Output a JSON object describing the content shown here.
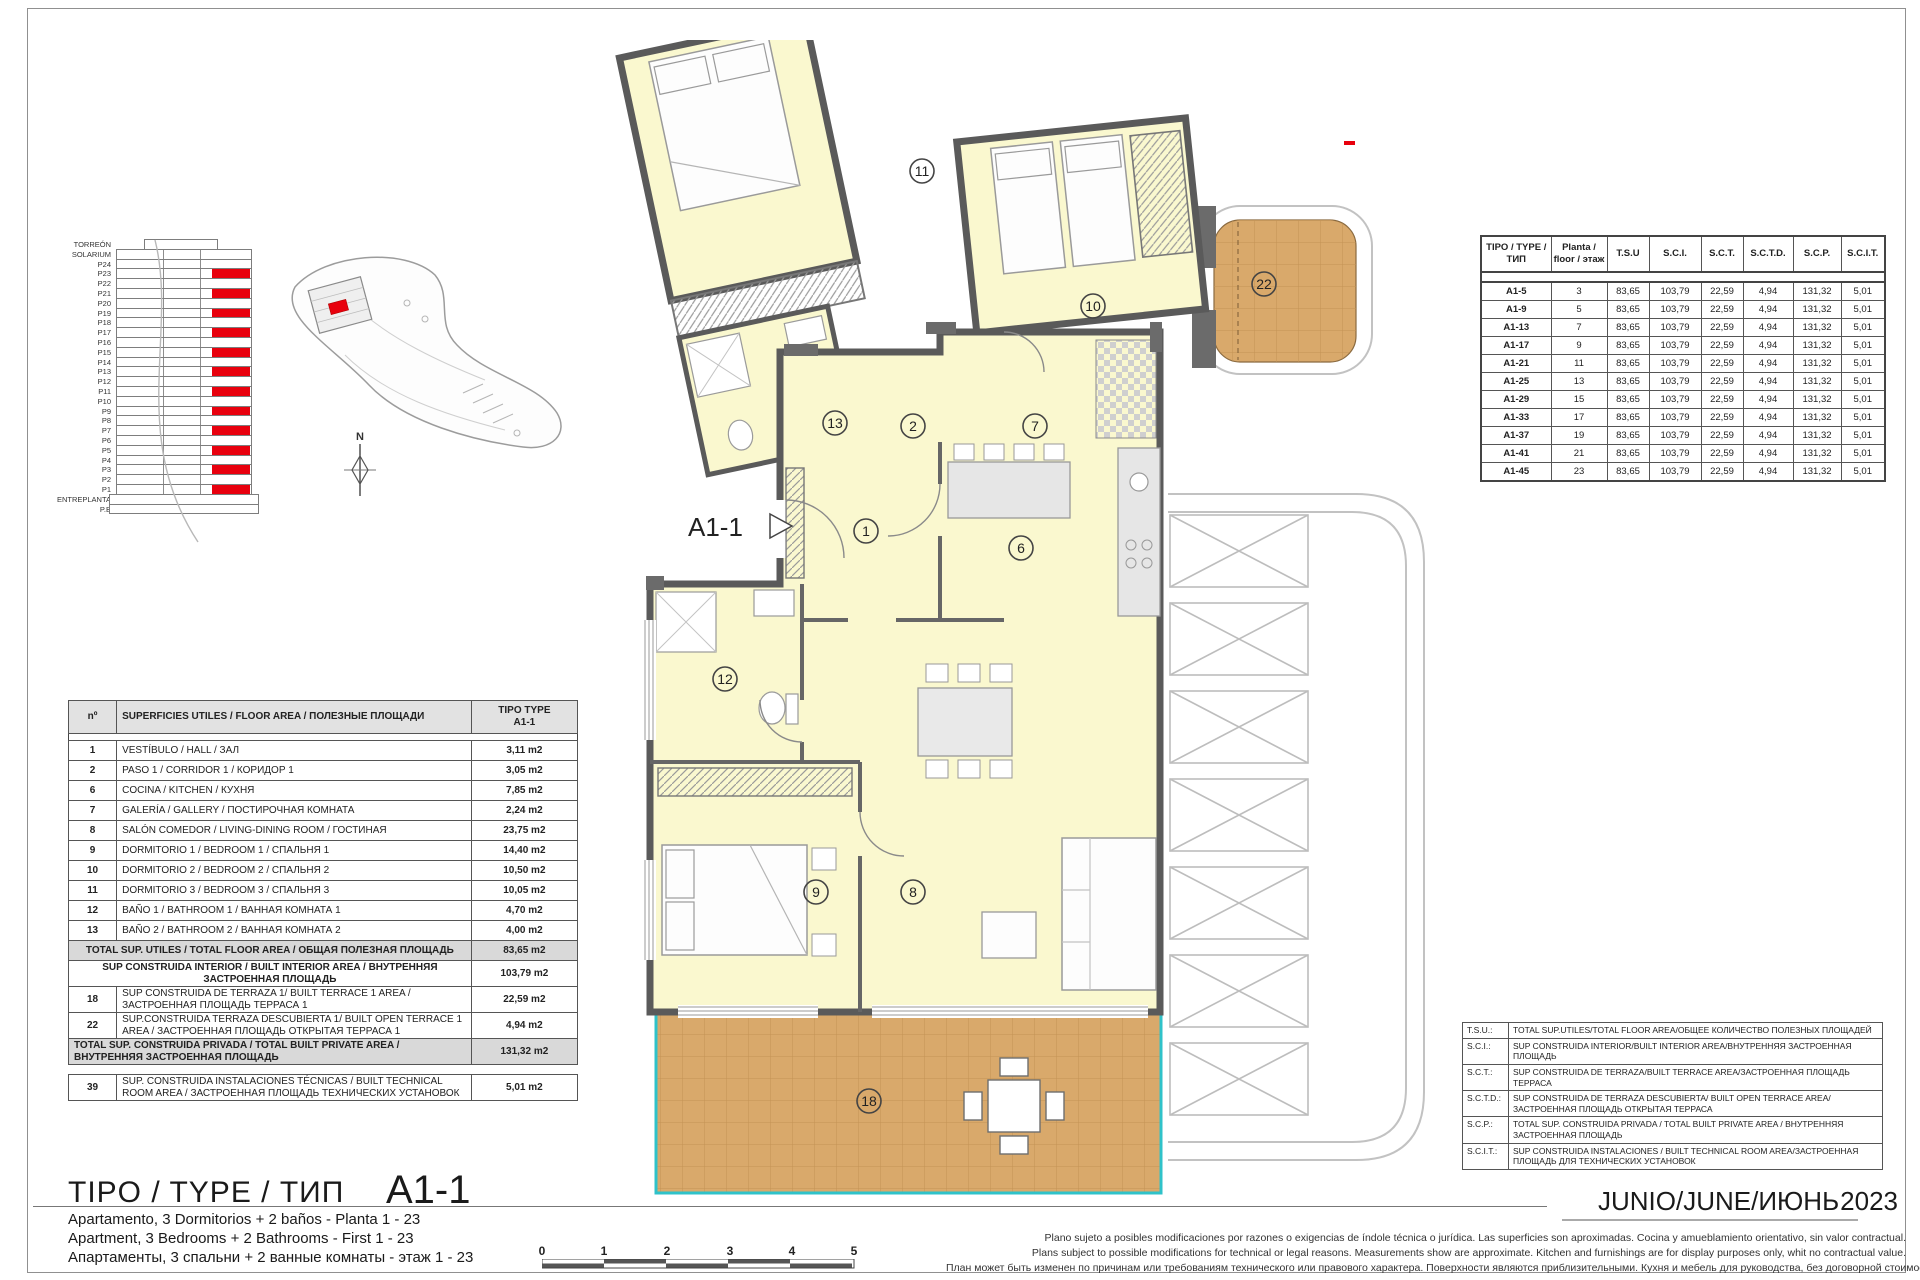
{
  "elevation": {
    "floors": [
      {
        "label": "TORREÓN",
        "red": false
      },
      {
        "label": "SOLARIUM",
        "red": false
      },
      {
        "label": "P24",
        "red": false
      },
      {
        "label": "P23",
        "red": true
      },
      {
        "label": "P22",
        "red": false
      },
      {
        "label": "P21",
        "red": true
      },
      {
        "label": "P20",
        "red": false
      },
      {
        "label": "P19",
        "red": true
      },
      {
        "label": "P18",
        "red": false
      },
      {
        "label": "P17",
        "red": true
      },
      {
        "label": "P16",
        "red": false
      },
      {
        "label": "P15",
        "red": true
      },
      {
        "label": "P14",
        "red": false
      },
      {
        "label": "P13",
        "red": true
      },
      {
        "label": "P12",
        "red": false
      },
      {
        "label": "P11",
        "red": true
      },
      {
        "label": "P10",
        "red": false
      },
      {
        "label": "P9",
        "red": true
      },
      {
        "label": "P8",
        "red": false
      },
      {
        "label": "P7",
        "red": true
      },
      {
        "label": "P6",
        "red": false
      },
      {
        "label": "P5",
        "red": true
      },
      {
        "label": "P4",
        "red": false
      },
      {
        "label": "P3",
        "red": true
      },
      {
        "label": "P2",
        "red": false
      },
      {
        "label": "P1",
        "red": true
      },
      {
        "label": "ENTREPLANTA",
        "red": false
      },
      {
        "label": "P.B",
        "red": false
      }
    ]
  },
  "compass": {
    "north": "N"
  },
  "plan": {
    "label": "A1-1",
    "rooms": {
      "r1": "1",
      "r2": "2",
      "r6": "6",
      "r7": "7",
      "r8": "8",
      "r9": "9",
      "r10": "10",
      "r11": "11",
      "r12": "12",
      "r13": "13",
      "r18": "18",
      "r22": "22"
    }
  },
  "type_table": {
    "headers": [
      "TIPO / TYPE / ТИП",
      "Planta / floor / этаж",
      "T.S.U",
      "S.C.I.",
      "S.C.T.",
      "S.C.T.D.",
      "S.C.P.",
      "S.C.I.T."
    ],
    "rows": [
      [
        "A1-5",
        "3",
        "83,65",
        "103,79",
        "22,59",
        "4,94",
        "131,32",
        "5,01"
      ],
      [
        "A1-9",
        "5",
        "83,65",
        "103,79",
        "22,59",
        "4,94",
        "131,32",
        "5,01"
      ],
      [
        "A1-13",
        "7",
        "83,65",
        "103,79",
        "22,59",
        "4,94",
        "131,32",
        "5,01"
      ],
      [
        "A1-17",
        "9",
        "83,65",
        "103,79",
        "22,59",
        "4,94",
        "131,32",
        "5,01"
      ],
      [
        "A1-21",
        "11",
        "83,65",
        "103,79",
        "22,59",
        "4,94",
        "131,32",
        "5,01"
      ],
      [
        "A1-25",
        "13",
        "83,65",
        "103,79",
        "22,59",
        "4,94",
        "131,32",
        "5,01"
      ],
      [
        "A1-29",
        "15",
        "83,65",
        "103,79",
        "22,59",
        "4,94",
        "131,32",
        "5,01"
      ],
      [
        "A1-33",
        "17",
        "83,65",
        "103,79",
        "22,59",
        "4,94",
        "131,32",
        "5,01"
      ],
      [
        "A1-37",
        "19",
        "83,65",
        "103,79",
        "22,59",
        "4,94",
        "131,32",
        "5,01"
      ],
      [
        "A1-41",
        "21",
        "83,65",
        "103,79",
        "22,59",
        "4,94",
        "131,32",
        "5,01"
      ],
      [
        "A1-45",
        "23",
        "83,65",
        "103,79",
        "22,59",
        "4,94",
        "131,32",
        "5,01"
      ]
    ]
  },
  "area_table": {
    "col_no": "nº",
    "col_desc": "SUPERFICIES UTILES / FLOOR AREA / ПОЛЕЗНЫЕ ПЛОЩАДИ",
    "col_type_l1": "TIPO TYPE",
    "col_type_l2": "A1-1",
    "rows": [
      [
        "1",
        "VESTÍBULO / HALL / ЗАЛ",
        "3,11 m2"
      ],
      [
        "2",
        "PASO 1 / CORRIDOR 1 / КОРИДОР 1",
        "3,05 m2"
      ],
      [
        "6",
        "COCINA / KITCHEN / КУХНЯ",
        "7,85 m2"
      ],
      [
        "7",
        "GALERÍA / GALLERY / ПОСТИРОЧНАЯ КОМНАТА",
        "2,24 m2"
      ],
      [
        "8",
        "SALÓN COMEDOR / LIVING-DINING ROOM / ГОСТИНАЯ",
        "23,75 m2"
      ],
      [
        "9",
        "DORMITORIO 1 / BEDROOM 1 / СПАЛЬНЯ 1",
        "14,40 m2"
      ],
      [
        "10",
        "DORMITORIO 2 / BEDROOM 2 / СПАЛЬНЯ 2",
        "10,50 m2"
      ],
      [
        "11",
        "DORMITORIO 3 / BEDROOM 3 / СПАЛЬНЯ 3",
        "10,05 m2"
      ],
      [
        "12",
        "BAÑO 1 / BATHROOM 1 / ВАННАЯ КОМНАТА 1",
        "4,70 m2"
      ],
      [
        "13",
        "BAÑO 2 / BATHROOM 2 / ВАННАЯ КОМНАТА 2",
        "4,00 m2"
      ]
    ],
    "total_utiles": {
      "label": "TOTAL SUP. UTILES / TOTAL FLOOR AREA / ОБЩАЯ ПОЛЕЗНАЯ ПЛОЩАДЬ",
      "value": "83,65 m2"
    },
    "interior": {
      "label": "SUP CONSTRUIDA INTERIOR / BUILT INTERIOR AREA / ВНУТРЕННЯЯ ЗАСТРОЕННАЯ ПЛОЩАДЬ",
      "value": "103,79 m2"
    },
    "terraza1": {
      "no": "18",
      "label": "SUP CONSTRUIDA DE TERRAZA 1/ BUILT TERRACE 1 AREA / ЗАСТРОЕННАЯ ПЛОЩАДЬ ТЕРРАСА 1",
      "value": "22,59 m2"
    },
    "terraza_desc": {
      "no": "22",
      "label": "SUP.CONSTRUIDA TERRAZA DESCUBIERTA 1/ BUILT OPEN TERRACE 1 AREA / ЗАСТРОЕННАЯ ПЛОЩАДЬ ОТКРЫТАЯ ТЕРРАСА 1",
      "value": "4,94 m2"
    },
    "total_privada": {
      "label": "TOTAL SUP. CONSTRUIDA PRIVADA / TOTAL BUILT PRIVATE AREA / ВНУТРЕННЯЯ ЗАСТРОЕННАЯ ПЛОЩАДЬ",
      "value": "131,32 m2"
    },
    "tech": {
      "no": "39",
      "label": "SUP. CONSTRUIDA INSTALACIONES TÉCNICAS / BUILT TECHNICAL ROOM AREA / ЗАСТРОЕННАЯ ПЛОЩАДЬ ТЕХНИЧЕСКИХ УСТАНОВОК",
      "value": "5,01 m2"
    }
  },
  "legend": {
    "rows": [
      {
        "abbr": "T.S.U.:",
        "desc": "TOTAL SUP.UTILES/TOTAL FLOOR AREA/ОБЩЕЕ КОЛИЧЕСТВО ПОЛЕЗНЫХ ПЛОЩАДЕЙ"
      },
      {
        "abbr": "S.C.I.:",
        "desc": "SUP CONSTRUIDA INTERIOR/BUILT INTERIOR AREA/ВНУТРЕННЯЯ ЗАСТРОЕННАЯ ПЛОЩАДЬ"
      },
      {
        "abbr": "S.C.T.:",
        "desc": "SUP CONSTRUIDA DE TERRAZA/BUILT TERRACE AREA/ЗАСТРОЕННАЯ ПЛОЩАДЬ ТЕРРАСА"
      },
      {
        "abbr": "S.C.T.D.:",
        "desc": "SUP CONSTRUIDA DE TERRAZA DESCUBIERTA/ BUILT OPEN TERRACE AREA/ЗАСТРОЕННАЯ ПЛОЩАДЬ ОТКРЫТАЯ ТЕРРАСА"
      },
      {
        "abbr": "S.C.P.:",
        "desc": "TOTAL SUP. CONSTRUIDA PRIVADA / TOTAL  BUILT PRIVATE AREA / ВНУТРЕННЯЯ ЗАСТРОЕННАЯ ПЛОЩАДЬ"
      },
      {
        "abbr": "S.C.I.T.:",
        "desc": "SUP CONSTRUIDA INSTALACIONES / BUILT TECHNICAL ROOM AREA/ЗАСТРОЕННАЯ ПЛОЩАДЬ ДЛЯ ТЕХНИЧЕСКИХ УСТАНОВОК"
      }
    ]
  },
  "footer": {
    "title": "TIPO / TYPE / ТИП",
    "code": "A1-1",
    "desc_es": "Apartamento, 3 Dormitorios + 2 baños - Planta 1 - 23",
    "desc_en": "Apartment, 3 Bedrooms + 2 Bathrooms - First 1 - 23",
    "desc_ru": "Апартаменты, 3 спальни + 2 ванные комнаты - этаж 1 - 23",
    "date": "JUNIO/JUNE/ИЮНЬ",
    "year": "2023",
    "disclaimer_es": "Plano sujeto a posibles modificaciones por razones o exigencias de índole técnica o jurídica. Las superficies son aproximadas. Cocina y amueblamiento orientativo, sin valor contractual.",
    "disclaimer_en": "Plans subject to possible modifications for technical or legal reasons. Measurements show are approximate. Kitchen and furnishings are for display purposes only, whit no contractual value.",
    "disclaimer_ru": "План может быть изменен по причинам или требованиям технического или правового характера. Поверхности являются приблизительными. Кухня и мебель для руководства, без договорной стоимости."
  },
  "scale_bar": {
    "ticks": [
      "0",
      "1",
      "2",
      "3",
      "4",
      "5"
    ]
  },
  "colors": {
    "accent_red": "#e8000d",
    "room_fill": "#faf8cf",
    "terrace_fill": "#d9a96b",
    "teal": "#2fc2c9",
    "wall": "#5a5a5a"
  }
}
